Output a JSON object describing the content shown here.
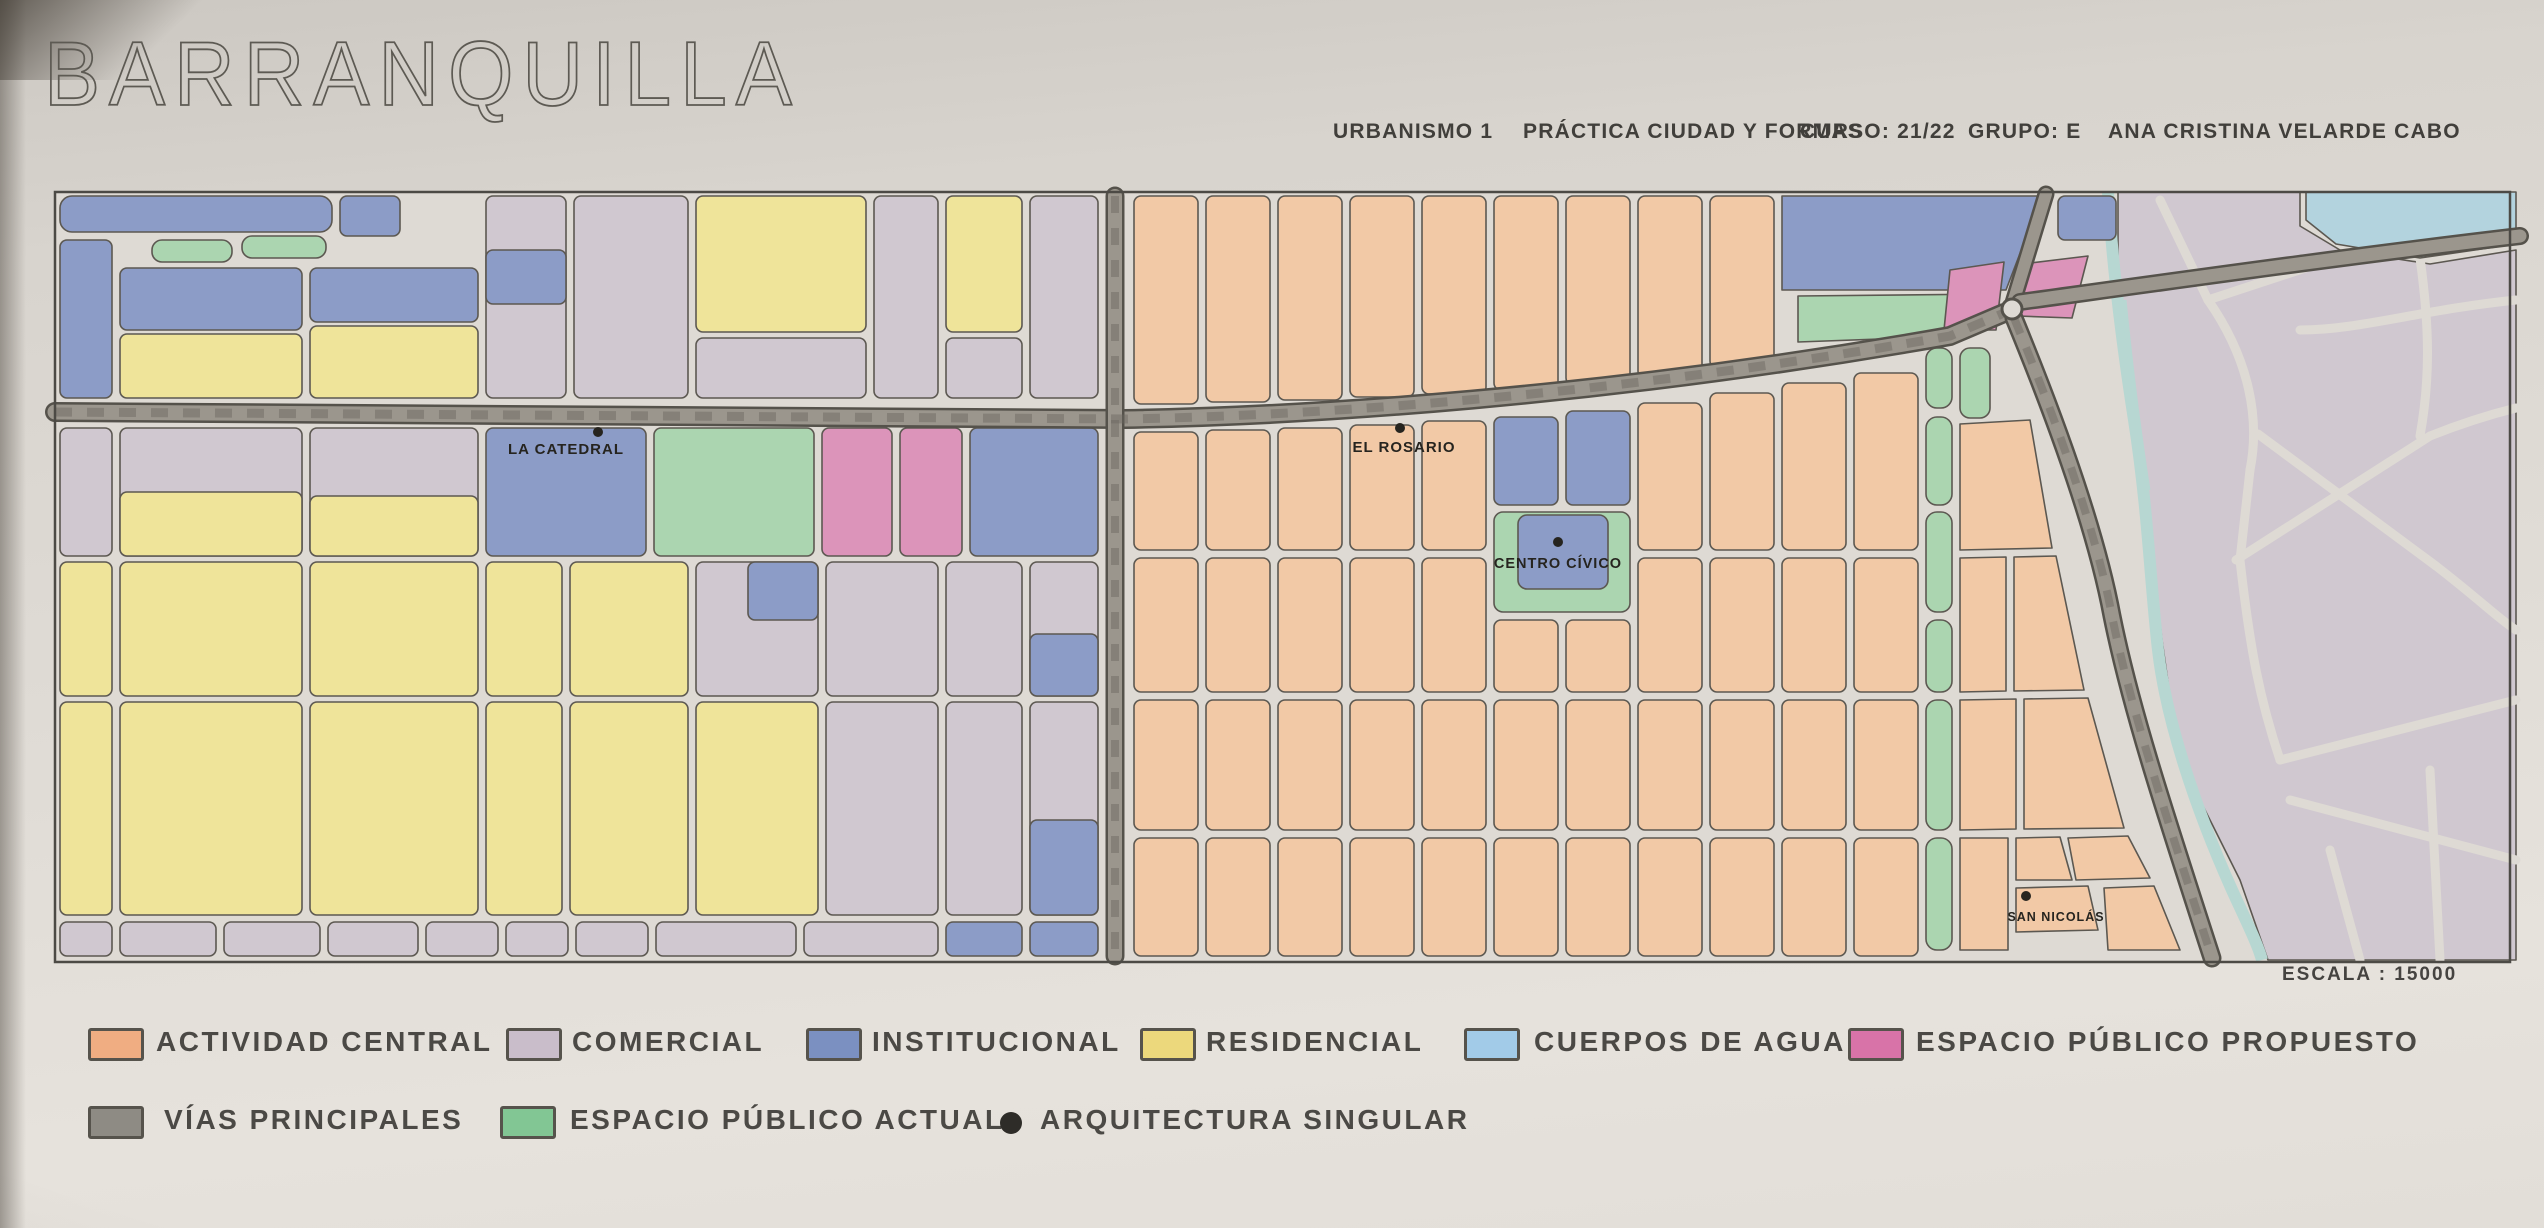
{
  "title": "BARRANQUILLA",
  "header": {
    "items": [
      "URBANISMO 1",
      "PRÁCTICA CIUDAD Y FORMAS",
      "CURSO: 21/22",
      "GRUPO: E",
      "ANA CRISTINA VELARDE CABO"
    ]
  },
  "map": {
    "scale_label": "ESCALA : 15000",
    "landmarks": [
      {
        "name": "LA CATEDRAL"
      },
      {
        "name": "EL ROSARIO"
      },
      {
        "name": "CENTRO CÍVICO"
      },
      {
        "name": "SAN NICOLÁS"
      }
    ]
  },
  "legend": {
    "rows": [
      [
        {
          "key": "actividad-central",
          "label": "ACTIVIDAD CENTRAL",
          "color": "#f0ad82",
          "marker": "swatch"
        },
        {
          "key": "comercial",
          "label": "COMERCIAL",
          "color": "#c9bdca",
          "marker": "swatch"
        },
        {
          "key": "institucional",
          "label": "INSTITUCIONAL",
          "color": "#7b90c1",
          "marker": "swatch"
        },
        {
          "key": "residencial",
          "label": "RESIDENCIAL",
          "color": "#ecd87c",
          "marker": "swatch"
        },
        {
          "key": "cuerpos-de-agua",
          "label": "CUERPOS DE AGUA",
          "color": "#a2cbe8",
          "marker": "swatch"
        },
        {
          "key": "espacio-publico-propuesto",
          "label": "ESPACIO PÚBLICO PROPUESTO",
          "color": "#d873a8",
          "marker": "swatch"
        }
      ],
      [
        {
          "key": "vias-principales",
          "label": "VÍAS PRINCIPALES",
          "color": "#8e8b84",
          "marker": "swatch"
        },
        {
          "key": "espacio-publico-actual",
          "label": "ESPACIO PÚBLICO ACTUAL",
          "color": "#82c694",
          "marker": "swatch"
        },
        {
          "key": "arquitectura-singular",
          "label": "ARQUITECTURA SINGULAR",
          "color": "#2e2c28",
          "marker": "dot"
        }
      ]
    ]
  },
  "zone_colors": {
    "orange": "#f2c9a6",
    "lavender": "#d0c8d0",
    "blue": "#8c9cc7",
    "yellow": "#efe49a",
    "green": "#abd5b0",
    "pink": "#dc94ba",
    "water": "#b3d3de",
    "river": "#b7d7d2",
    "road": "#9b968d",
    "road_edge": "#55524b",
    "street": "#dedad4",
    "stroke": "#5c5851",
    "ink": "#26241f"
  }
}
